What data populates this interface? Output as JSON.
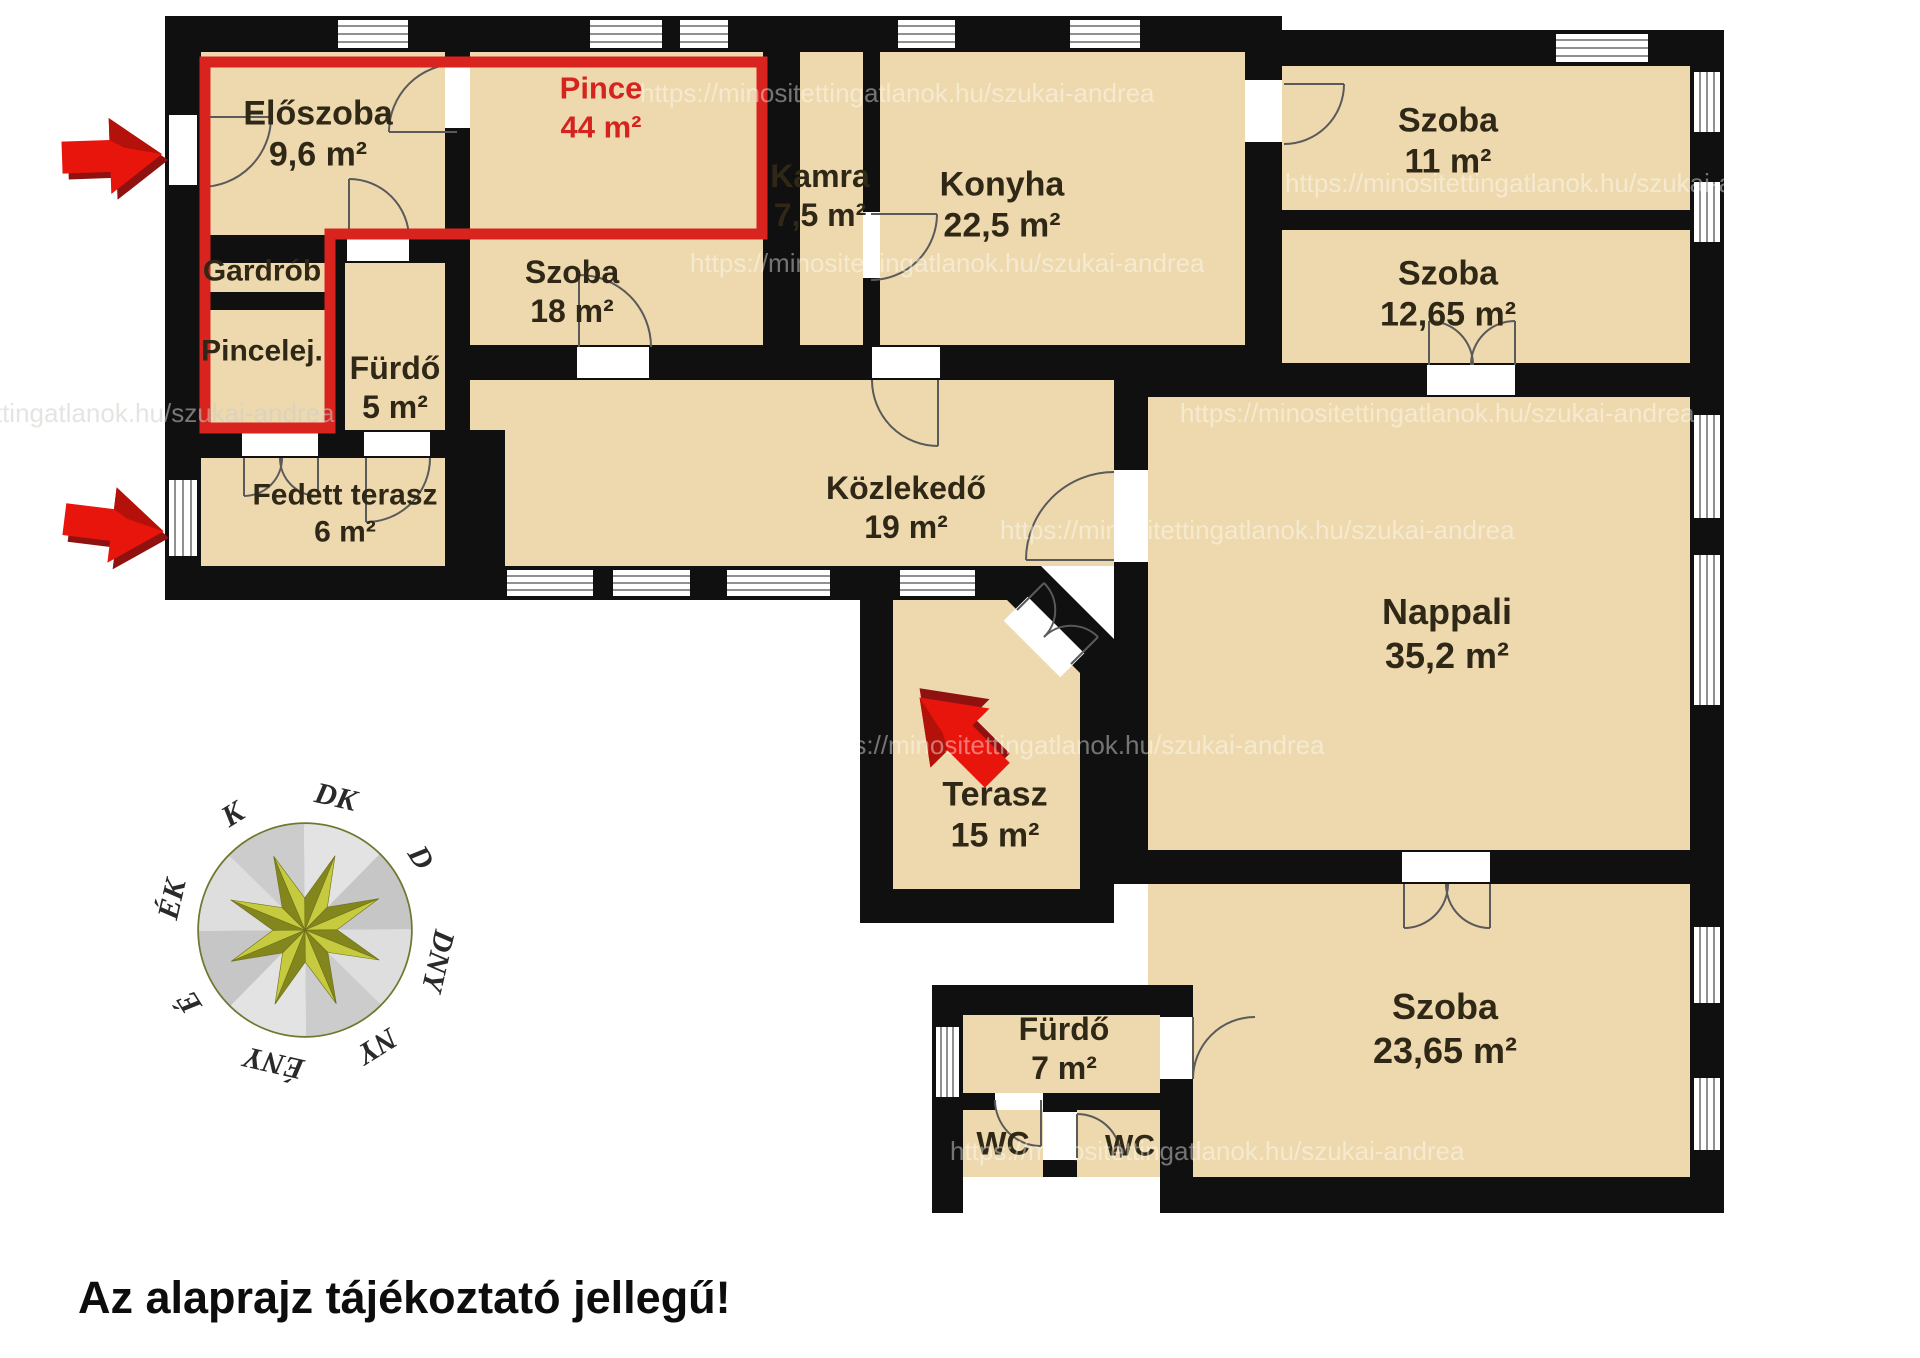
{
  "meta": {
    "disclaimer": "Az alaprajz tájékoztató jellegű!",
    "watermark": "https://minositettingatlanok.hu/szukai-andrea"
  },
  "overlay": {
    "label": "Pince",
    "area": "44 m²"
  },
  "rooms": [
    {
      "name": "Előszoba",
      "area": "9,6 m²"
    },
    {
      "name": "Gardrób",
      "area": ""
    },
    {
      "name": "Pincelej.",
      "area": ""
    },
    {
      "name": "Fürdő",
      "area": "5 m²"
    },
    {
      "name": "Szoba",
      "area": "18 m²"
    },
    {
      "name": "Kamra",
      "area": "7,5 m²"
    },
    {
      "name": "Konyha",
      "area": "22,5 m²"
    },
    {
      "name": "Szoba",
      "area": "11 m²"
    },
    {
      "name": "Szoba",
      "area": "12,65 m²"
    },
    {
      "name": "Fedett terasz",
      "area": "6 m²"
    },
    {
      "name": "Közlekedő",
      "area": "19 m²"
    },
    {
      "name": "Nappali",
      "area": "35,2 m²"
    },
    {
      "name": "Terasz",
      "area": "15 m²"
    },
    {
      "name": "Fürdő",
      "area": "7 m²"
    },
    {
      "name": "WC",
      "area": ""
    },
    {
      "name": "WC",
      "area": ""
    },
    {
      "name": "Szoba",
      "area": "23,65 m²"
    }
  ],
  "compass": {
    "labels": [
      "DK",
      "D",
      "DNY",
      "NY",
      "ÉNY",
      "É",
      "ÉK",
      "K"
    ]
  },
  "colors": {
    "room_fill": "#eed9ae",
    "wall": "#101010",
    "overlay_red": "#d8231e",
    "arrow_red": "#e8150d",
    "compass_star_light": "#c6ca3e",
    "compass_star_dark": "#83861c"
  }
}
